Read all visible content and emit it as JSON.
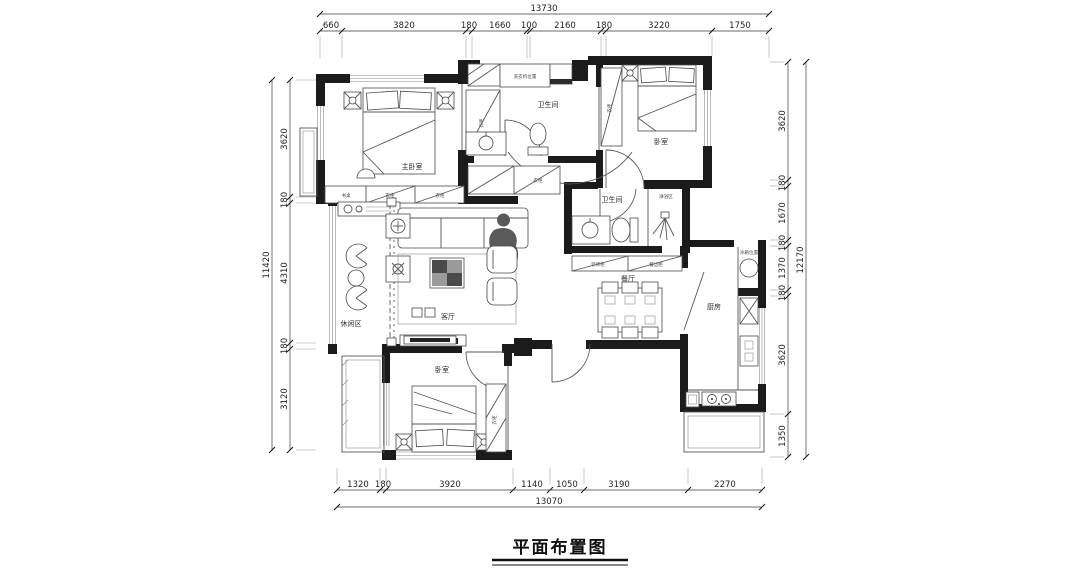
{
  "title": "平面布置图",
  "rooms": {
    "master_bedroom": "主卧室",
    "bathroom_top": "卫生间",
    "bedroom_right": "卧室",
    "leisure_area": "休闲区",
    "living_room": "客厅",
    "bathroom_mid": "卫生间",
    "shower_area": "淋浴区",
    "dining_room": "餐厅",
    "kitchen": "厨房",
    "bedroom_bottom": "卧室"
  },
  "annotations": {
    "wardrobe": "衣柜",
    "desk": "书桌",
    "washer": "洗衣机位置",
    "fridge": "冰箱位置",
    "decor_cabinet": "装饰柜",
    "sideboard": "餐边柜"
  },
  "dimensions": {
    "top_total": "13730",
    "top_segments": [
      "660",
      "3820",
      "180",
      "1660",
      "100",
      "2160",
      "180",
      "3220",
      "1750"
    ],
    "bottom_segments": [
      "1320",
      "180",
      "3920",
      "1140",
      "1050",
      "3190",
      "2270"
    ],
    "bottom_total": "13070",
    "left_total": "11420",
    "left_segments": [
      "3620",
      "180",
      "4310",
      "180",
      "3120"
    ],
    "right_segments": [
      "3620",
      "180",
      "1670",
      "180",
      "1370",
      "180",
      "3620",
      "1350"
    ],
    "right_total": "12170"
  }
}
